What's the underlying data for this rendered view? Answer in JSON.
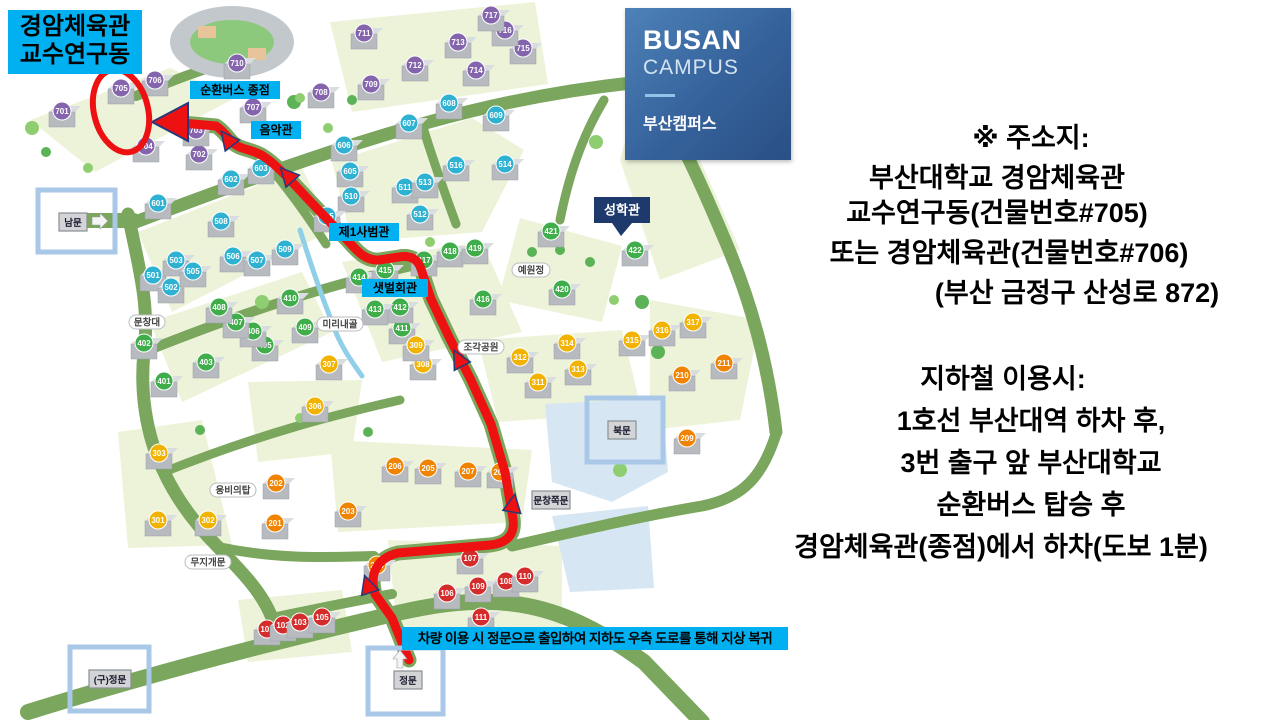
{
  "logo": {
    "title": "BUSAN",
    "subtitle": "CAMPUS",
    "korean": "부산캠퍼스"
  },
  "right_panel": {
    "address_block": {
      "lines": [
        "※ 주소지:",
        "부산대학교 경암체육관",
        "교수연구동(건물번호#705)",
        "또는 경암체육관(건물번호#706)",
        "(부산 금정구 산성로 872)"
      ]
    },
    "subway_block": {
      "lines": [
        "지하철 이용시:",
        "1호선 부산대역 하차 후,",
        "3번 출구 앞 부산대학교",
        "순환버스 탑승 후",
        "경암체육관(종점)에서 하차(도보 1분)"
      ]
    }
  },
  "map": {
    "destination_banner": {
      "line1": "경암체육관",
      "line2": "교수연구동",
      "bg": "#00b0f0"
    },
    "car_note": {
      "text": "차량 이용 시 정문으로 출입하여 지하도 우측 도로를 통해 지상 복귀",
      "bg": "#00b0f0"
    },
    "route_labels": [
      {
        "id": "sunhwan-bus-terminal",
        "text": "순환버스 종점",
        "x": 235,
        "y": 90,
        "w": 90
      },
      {
        "id": "eumakgwan",
        "text": "음악관",
        "x": 276,
        "y": 130,
        "w": 50
      },
      {
        "id": "jeil-sabeomgwan",
        "text": "제1사범관",
        "x": 364,
        "y": 232,
        "w": 70
      },
      {
        "id": "saetbeol-hoegwan",
        "text": "샛벌회관",
        "x": 395,
        "y": 288,
        "w": 66
      }
    ],
    "place_labels": [
      {
        "id": "munchangdae",
        "text": "문창대",
        "x": 147,
        "y": 322,
        "w": 36
      },
      {
        "id": "mirinaegol",
        "text": "미리내골",
        "x": 340,
        "y": 324,
        "w": 46
      },
      {
        "id": "jogak-park",
        "text": "조각공원",
        "x": 481,
        "y": 347,
        "w": 46
      },
      {
        "id": "yewonjeong",
        "text": "예원정",
        "x": 531,
        "y": 270,
        "w": 38
      },
      {
        "id": "ungbi-tower",
        "text": "웅비의탑",
        "x": 233,
        "y": 490,
        "w": 46
      },
      {
        "id": "mujigae-gate",
        "text": "무지개문",
        "x": 208,
        "y": 562,
        "w": 46
      }
    ],
    "callouts": [
      {
        "id": "seonghakgwan",
        "text": "성학관",
        "x": 622,
        "y": 210,
        "w": 56,
        "h": 26,
        "bg": "#1e3a6d"
      }
    ],
    "gates": [
      {
        "id": "nammun",
        "label": "남문",
        "x": 73,
        "y": 222,
        "w": 28,
        "box": [
          38,
          190,
          77,
          62
        ],
        "arrow": "right"
      },
      {
        "id": "bukmun",
        "label": "북문",
        "x": 622,
        "y": 430,
        "w": 28,
        "box": [
          587,
          398,
          76,
          64
        ],
        "arrow": ""
      },
      {
        "id": "munchang-side-gate",
        "label": "문창쪽문",
        "x": 551,
        "y": 500,
        "w": 38,
        "box": null,
        "arrow": ""
      },
      {
        "id": "jeongmun",
        "label": "정문",
        "x": 408,
        "y": 680,
        "w": 28,
        "box": [
          368,
          648,
          75,
          66
        ],
        "arrow": "up"
      },
      {
        "id": "old-jeongmun",
        "label": "(구)정문",
        "x": 110,
        "y": 679,
        "w": 42,
        "box": [
          70,
          647,
          79,
          64
        ],
        "arrow": ""
      }
    ],
    "building_colors": {
      "1": "#d42b2b",
      "2": "#f08300",
      "3": "#f2b200",
      "4": "#3fae4a",
      "5": "#2fb1d2",
      "6": "#2fb1d2",
      "7": "#8465ad"
    },
    "buildings": [
      {
        "n": "701",
        "x": 62,
        "y": 111
      },
      {
        "n": "702",
        "x": 199,
        "y": 154
      },
      {
        "n": "703",
        "x": 196,
        "y": 130
      },
      {
        "n": "704",
        "x": 146,
        "y": 146
      },
      {
        "n": "705",
        "x": 121,
        "y": 88
      },
      {
        "n": "706",
        "x": 155,
        "y": 80
      },
      {
        "n": "707",
        "x": 253,
        "y": 107
      },
      {
        "n": "708",
        "x": 321,
        "y": 92
      },
      {
        "n": "709",
        "x": 371,
        "y": 84
      },
      {
        "n": "710",
        "x": 237,
        "y": 63
      },
      {
        "n": "711",
        "x": 364,
        "y": 33
      },
      {
        "n": "712",
        "x": 415,
        "y": 65
      },
      {
        "n": "713",
        "x": 458,
        "y": 42
      },
      {
        "n": "714",
        "x": 476,
        "y": 70
      },
      {
        "n": "715",
        "x": 523,
        "y": 48
      },
      {
        "n": "716",
        "x": 505,
        "y": 30
      },
      {
        "n": "717",
        "x": 491,
        "y": 15
      },
      {
        "n": "601",
        "x": 158,
        "y": 203
      },
      {
        "n": "602",
        "x": 231,
        "y": 179
      },
      {
        "n": "603",
        "x": 261,
        "y": 168
      },
      {
        "n": "605",
        "x": 350,
        "y": 171
      },
      {
        "n": "606",
        "x": 344,
        "y": 145
      },
      {
        "n": "607",
        "x": 409,
        "y": 123
      },
      {
        "n": "608",
        "x": 449,
        "y": 103
      },
      {
        "n": "609",
        "x": 496,
        "y": 115
      },
      {
        "n": "501",
        "x": 153,
        "y": 275
      },
      {
        "n": "502",
        "x": 171,
        "y": 287
      },
      {
        "n": "503",
        "x": 176,
        "y": 260
      },
      {
        "n": "505",
        "x": 193,
        "y": 271
      },
      {
        "n": "506",
        "x": 233,
        "y": 256
      },
      {
        "n": "507",
        "x": 257,
        "y": 260
      },
      {
        "n": "508",
        "x": 221,
        "y": 221
      },
      {
        "n": "509",
        "x": 285,
        "y": 249
      },
      {
        "n": "510",
        "x": 351,
        "y": 196
      },
      {
        "n": "511",
        "x": 405,
        "y": 187
      },
      {
        "n": "512",
        "x": 420,
        "y": 214
      },
      {
        "n": "513",
        "x": 425,
        "y": 182
      },
      {
        "n": "514",
        "x": 505,
        "y": 164
      },
      {
        "n": "515",
        "x": 327,
        "y": 216
      },
      {
        "n": "516",
        "x": 456,
        "y": 165
      },
      {
        "n": "401",
        "x": 164,
        "y": 381
      },
      {
        "n": "402",
        "x": 144,
        "y": 343
      },
      {
        "n": "403",
        "x": 206,
        "y": 362
      },
      {
        "n": "405",
        "x": 265,
        "y": 345
      },
      {
        "n": "406",
        "x": 253,
        "y": 331
      },
      {
        "n": "407",
        "x": 236,
        "y": 322
      },
      {
        "n": "408",
        "x": 219,
        "y": 307
      },
      {
        "n": "409",
        "x": 305,
        "y": 327
      },
      {
        "n": "410",
        "x": 290,
        "y": 298
      },
      {
        "n": "411",
        "x": 402,
        "y": 328
      },
      {
        "n": "412",
        "x": 400,
        "y": 307
      },
      {
        "n": "413",
        "x": 375,
        "y": 309
      },
      {
        "n": "414",
        "x": 359,
        "y": 277
      },
      {
        "n": "415",
        "x": 385,
        "y": 270
      },
      {
        "n": "416",
        "x": 483,
        "y": 299
      },
      {
        "n": "417",
        "x": 424,
        "y": 260
      },
      {
        "n": "418",
        "x": 450,
        "y": 251
      },
      {
        "n": "419",
        "x": 475,
        "y": 248
      },
      {
        "n": "420",
        "x": 562,
        "y": 289
      },
      {
        "n": "421",
        "x": 551,
        "y": 231
      },
      {
        "n": "422",
        "x": 635,
        "y": 250
      },
      {
        "n": "301",
        "x": 158,
        "y": 520
      },
      {
        "n": "302",
        "x": 208,
        "y": 520
      },
      {
        "n": "303",
        "x": 159,
        "y": 453
      },
      {
        "n": "306",
        "x": 315,
        "y": 406
      },
      {
        "n": "307",
        "x": 329,
        "y": 364
      },
      {
        "n": "308",
        "x": 423,
        "y": 364
      },
      {
        "n": "309",
        "x": 416,
        "y": 345
      },
      {
        "n": "311",
        "x": 538,
        "y": 382
      },
      {
        "n": "312",
        "x": 520,
        "y": 357
      },
      {
        "n": "313",
        "x": 578,
        "y": 369
      },
      {
        "n": "314",
        "x": 567,
        "y": 343
      },
      {
        "n": "315",
        "x": 632,
        "y": 340
      },
      {
        "n": "316",
        "x": 662,
        "y": 330
      },
      {
        "n": "317",
        "x": 693,
        "y": 322
      },
      {
        "n": "201",
        "x": 275,
        "y": 523
      },
      {
        "n": "202",
        "x": 276,
        "y": 483
      },
      {
        "n": "203",
        "x": 348,
        "y": 511
      },
      {
        "n": "204",
        "x": 377,
        "y": 565
      },
      {
        "n": "205",
        "x": 428,
        "y": 468
      },
      {
        "n": "206",
        "x": 395,
        "y": 466
      },
      {
        "n": "207",
        "x": 468,
        "y": 471
      },
      {
        "n": "208",
        "x": 500,
        "y": 472
      },
      {
        "n": "209",
        "x": 687,
        "y": 438
      },
      {
        "n": "210",
        "x": 682,
        "y": 375
      },
      {
        "n": "211",
        "x": 724,
        "y": 363
      },
      {
        "n": "101",
        "x": 267,
        "y": 629
      },
      {
        "n": "102",
        "x": 283,
        "y": 625
      },
      {
        "n": "103",
        "x": 300,
        "y": 622
      },
      {
        "n": "105",
        "x": 322,
        "y": 617
      },
      {
        "n": "106",
        "x": 447,
        "y": 593
      },
      {
        "n": "107",
        "x": 470,
        "y": 558
      },
      {
        "n": "108",
        "x": 506,
        "y": 581
      },
      {
        "n": "109",
        "x": 478,
        "y": 586
      },
      {
        "n": "110",
        "x": 525,
        "y": 576
      },
      {
        "n": "111",
        "x": 481,
        "y": 617
      }
    ],
    "route": {
      "color": "#ee1111",
      "outline": "#233a7d",
      "path": "M 409,660 L 392,618 L 375,594 C 369,574 377,558 398,553 L 490,545 C 508,543 515,534 513,519 L 505,472 L 491,424 L 471,380 L 449,337 L 431,299 L 421,269 C 418,259 410,255 399,257 L 379,260 C 366,261 358,252 349,242 L 307,198 C 292,182 277,165 263,156 C 252,149 241,150 233,143 C 227,137 224,131 216,126 L 170,122",
      "arrows": [
        {
          "x": 368,
          "y": 586,
          "r": -18
        },
        {
          "x": 513,
          "y": 505,
          "r": 10
        },
        {
          "x": 459,
          "y": 360,
          "r": -28
        },
        {
          "x": 288,
          "y": 176,
          "r": -42
        },
        {
          "x": 228,
          "y": 140,
          "r": -38
        }
      ],
      "end_arrow": {
        "x": 152,
        "y": 122
      },
      "highlight_ellipse": {
        "cx": 121,
        "cy": 111,
        "rx": 27,
        "ry": 42,
        "rot": -14
      }
    },
    "highlight_box_color": "#a9c7e7"
  }
}
